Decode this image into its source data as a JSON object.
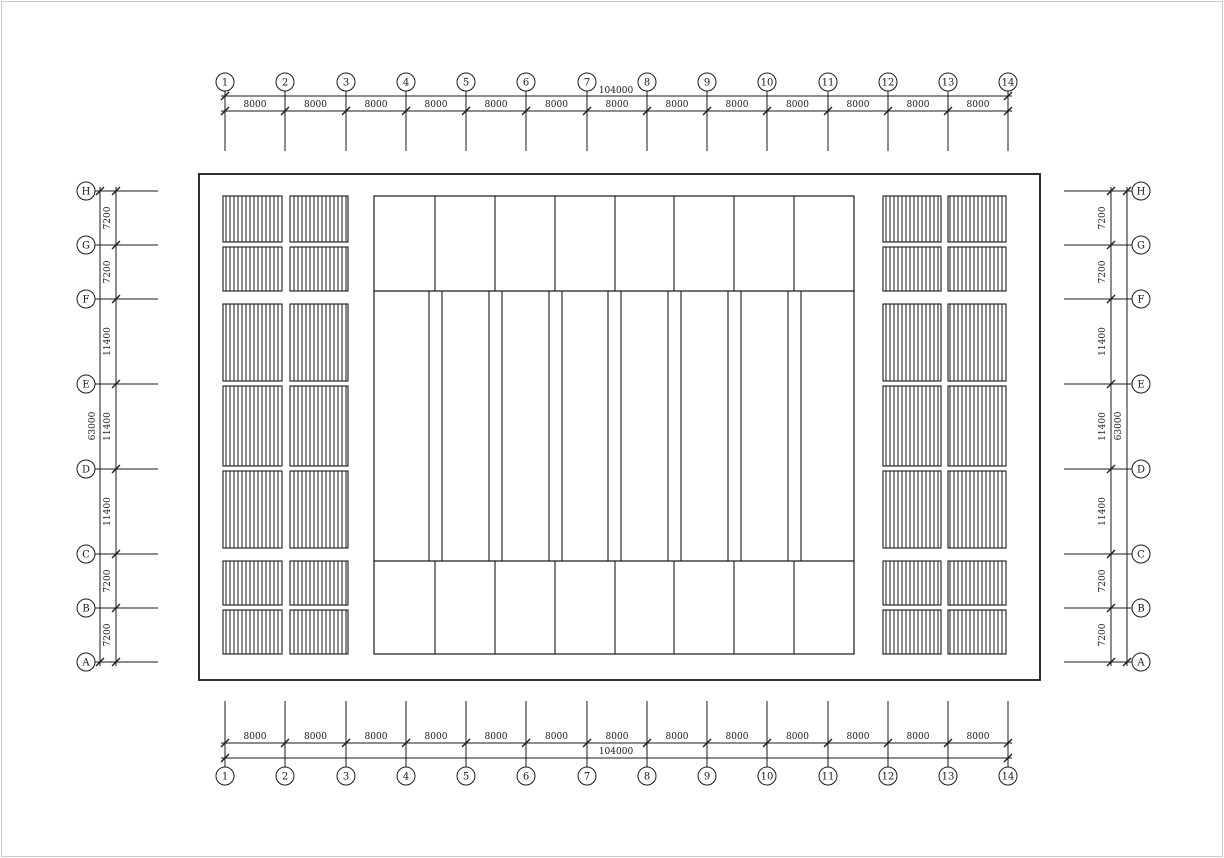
{
  "page": {
    "background_color": "#ffffff",
    "frame_border_color": "#cccccc",
    "line_color": "#1a1a1a"
  },
  "drawing": {
    "kind": "structural-plan",
    "column_grid": {
      "labels": [
        "1",
        "2",
        "3",
        "4",
        "5",
        "6",
        "7",
        "8",
        "9",
        "10",
        "11",
        "12",
        "13",
        "14"
      ],
      "bay_dimensions": [
        "8000",
        "8000",
        "8000",
        "8000",
        "8000",
        "8000",
        "8000",
        "8000",
        "8000",
        "8000",
        "8000",
        "8000",
        "8000"
      ],
      "overall_dimension": "104000"
    },
    "row_grid": {
      "labels": [
        "H",
        "G",
        "F",
        "E",
        "D",
        "C",
        "B",
        "A"
      ],
      "bay_dimensions": [
        "7200",
        "7200",
        "11400",
        "11400",
        "11400",
        "7200",
        "7200"
      ],
      "overall_dimension": "63000"
    }
  }
}
